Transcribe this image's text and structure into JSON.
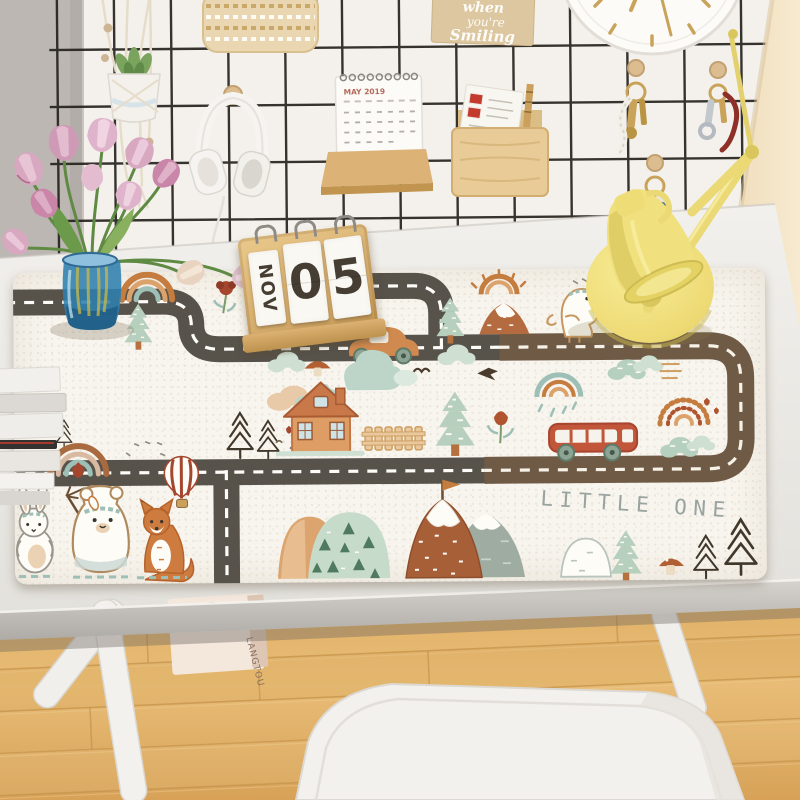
{
  "scene": {
    "name": "kids roadmap desk mat on white desk"
  },
  "wall": {
    "quote_card": {
      "line1": "when",
      "line2": "you're",
      "line3": "Smiling"
    },
    "calendar_title": "MAY 2019"
  },
  "desk": {
    "flip_calendar": {
      "month": "NOV",
      "digit1": "0",
      "digit2": "5"
    },
    "carton_brand": "LANGTOU"
  },
  "mat": {
    "title": "LITTLE ONE",
    "partial_word": "DR",
    "palette": {
      "mat_bg": "#f8f5ee",
      "road_dark": "#57524a",
      "road_brown": "#6f5a46",
      "terracotta": "#d08a4f",
      "rust": "#b0542f",
      "sage": "#b7d0bd",
      "teal": "#9dbfb6",
      "wood": "#ddb276",
      "lamp_yellow": "#f0e07e",
      "vase_blue": "#2f7fae",
      "tulip_pink": "#d8a8c0"
    }
  }
}
